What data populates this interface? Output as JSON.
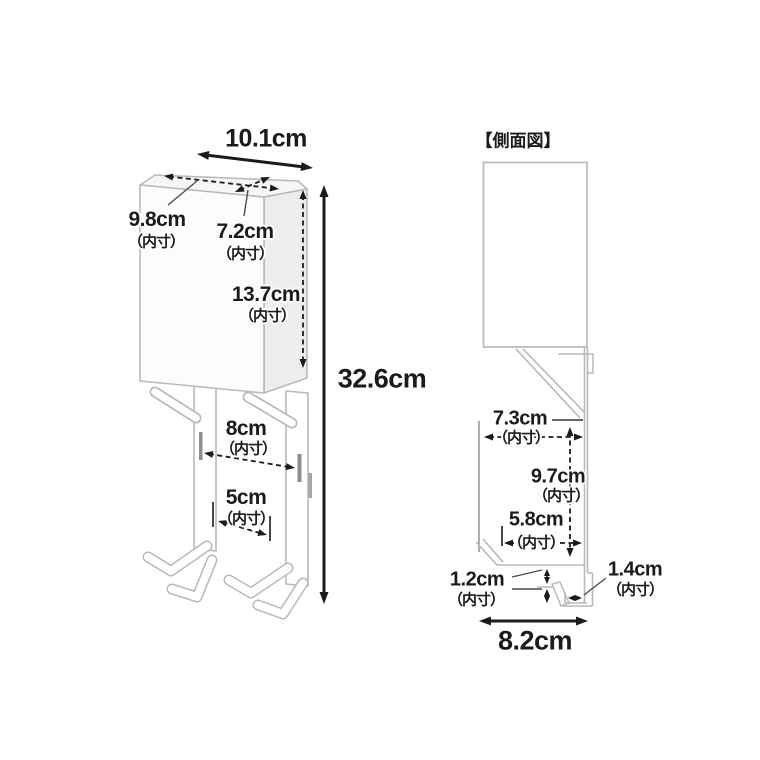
{
  "colors": {
    "background": "#ffffff",
    "product_line": "#b9b9b9",
    "dimension_ink": "#1d1a17",
    "product_fill": "#fcfcfc",
    "side_face_fill": "#ededed",
    "top_face_fill": "#f6f6f6"
  },
  "front_view": {
    "width_top": "10.1cm",
    "inner_depth": {
      "value": "9.8cm",
      "unit_note": "（内寸）"
    },
    "inner_width": {
      "value": "7.2cm",
      "unit_note": "（内寸）"
    },
    "inner_height": {
      "value": "13.7cm",
      "unit_note": "（内寸）"
    },
    "total_height": "32.6cm",
    "hook_gap_large": {
      "value": "8cm",
      "unit_note": "（内寸）"
    },
    "hook_gap_small": {
      "value": "5cm",
      "unit_note": "（内寸）"
    }
  },
  "side_view": {
    "title": "【側面図】",
    "inner_depth": {
      "value": "7.3cm",
      "unit_note": "（内寸）"
    },
    "inner_height": {
      "value": "9.7cm",
      "unit_note": "（内寸）"
    },
    "lower_inner_depth": {
      "value": "5.8cm",
      "unit_note": "（内寸）"
    },
    "hook_clearance": {
      "value": "1.2cm",
      "unit_note": "（内寸）"
    },
    "hook_slot_width": {
      "value": "1.4cm",
      "unit_note": "（内寸）"
    },
    "base_depth": "8.2cm"
  }
}
